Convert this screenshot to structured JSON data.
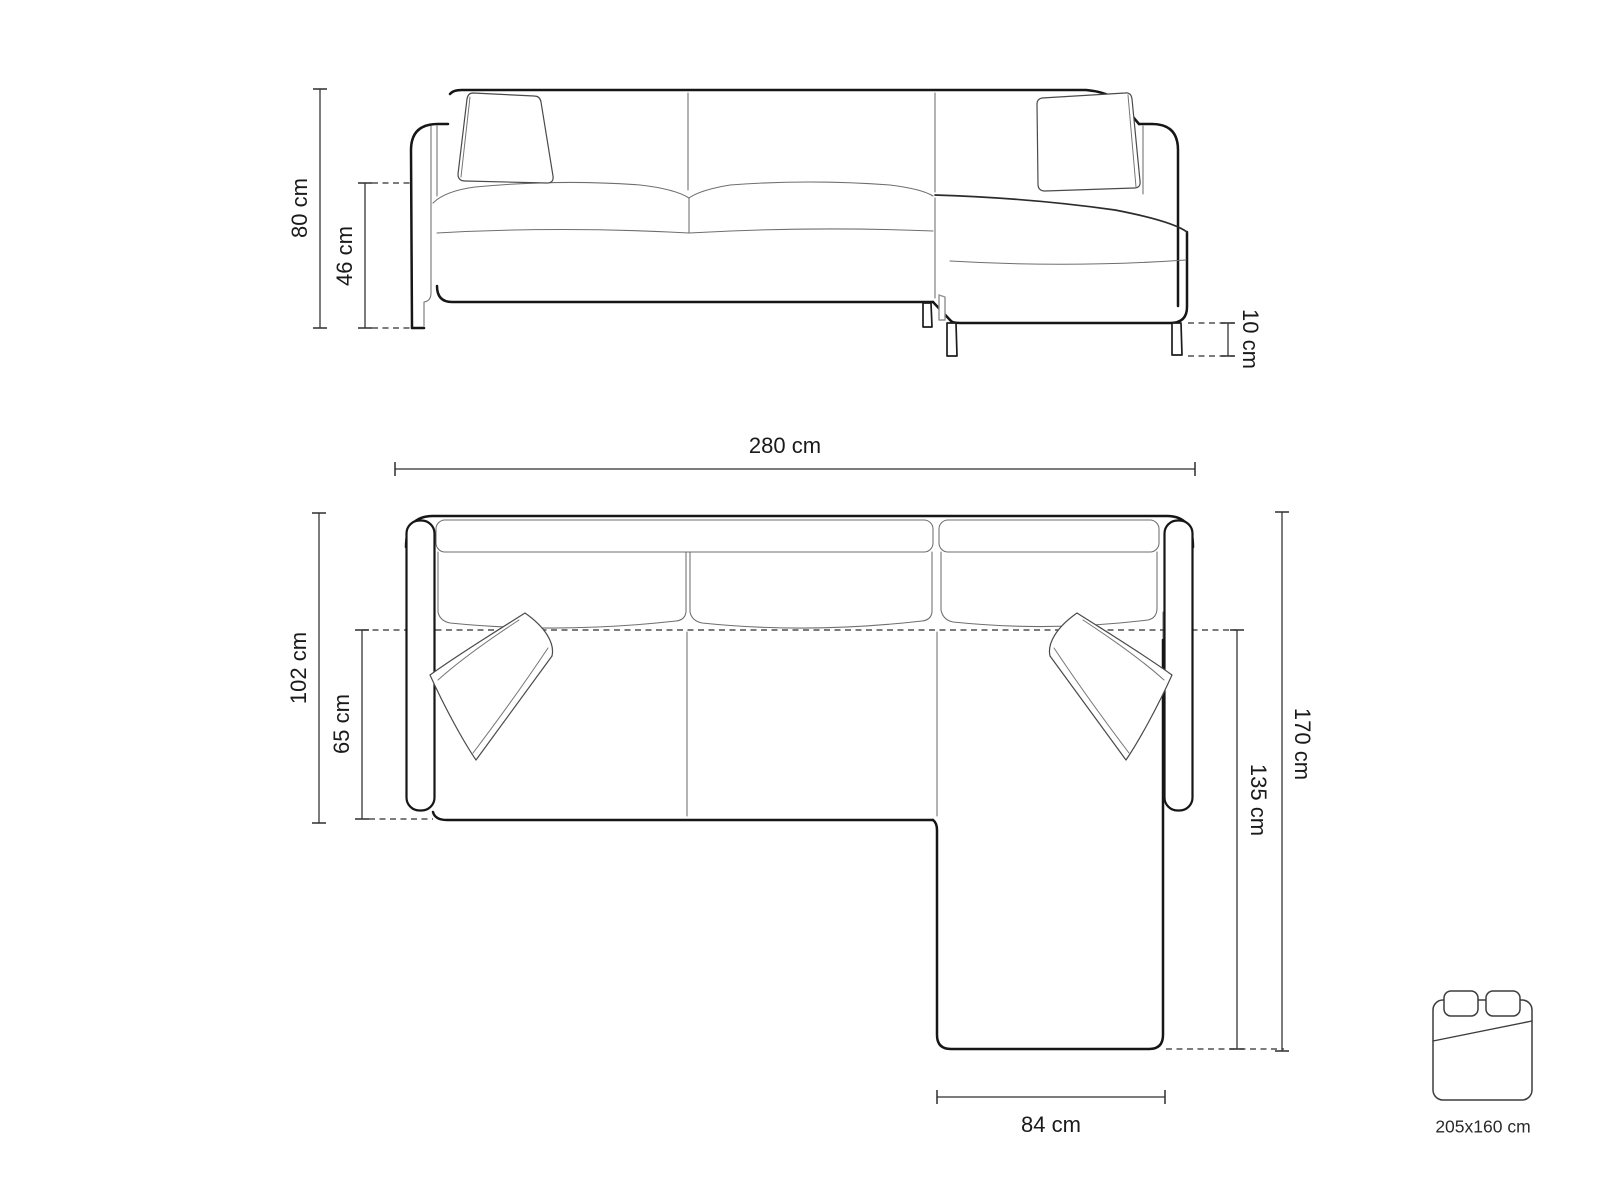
{
  "title": "Corner sofa technical dimensions diagram",
  "colors": {
    "background": "#ffffff",
    "outline": "#161616",
    "detail_line": "#6e6e6e",
    "dimension_line": "#2e2e2e",
    "label_text": "#1a1a1a"
  },
  "front_view": {
    "name": "sofa-front-elevation",
    "dimensions": {
      "total_height": "80 cm",
      "seat_height": "46 cm",
      "leg_height": "10 cm"
    }
  },
  "top_view": {
    "name": "sofa-plan-view",
    "dimensions": {
      "total_width": "280 cm",
      "total_depth": "102 cm",
      "seat_depth": "65 cm",
      "chaise_overall_length": "170 cm",
      "chaise_length": "135 cm",
      "chaise_width": "84 cm"
    }
  },
  "sleeping_area": {
    "icon": "bed-icon",
    "size_label": "205x160 cm"
  }
}
